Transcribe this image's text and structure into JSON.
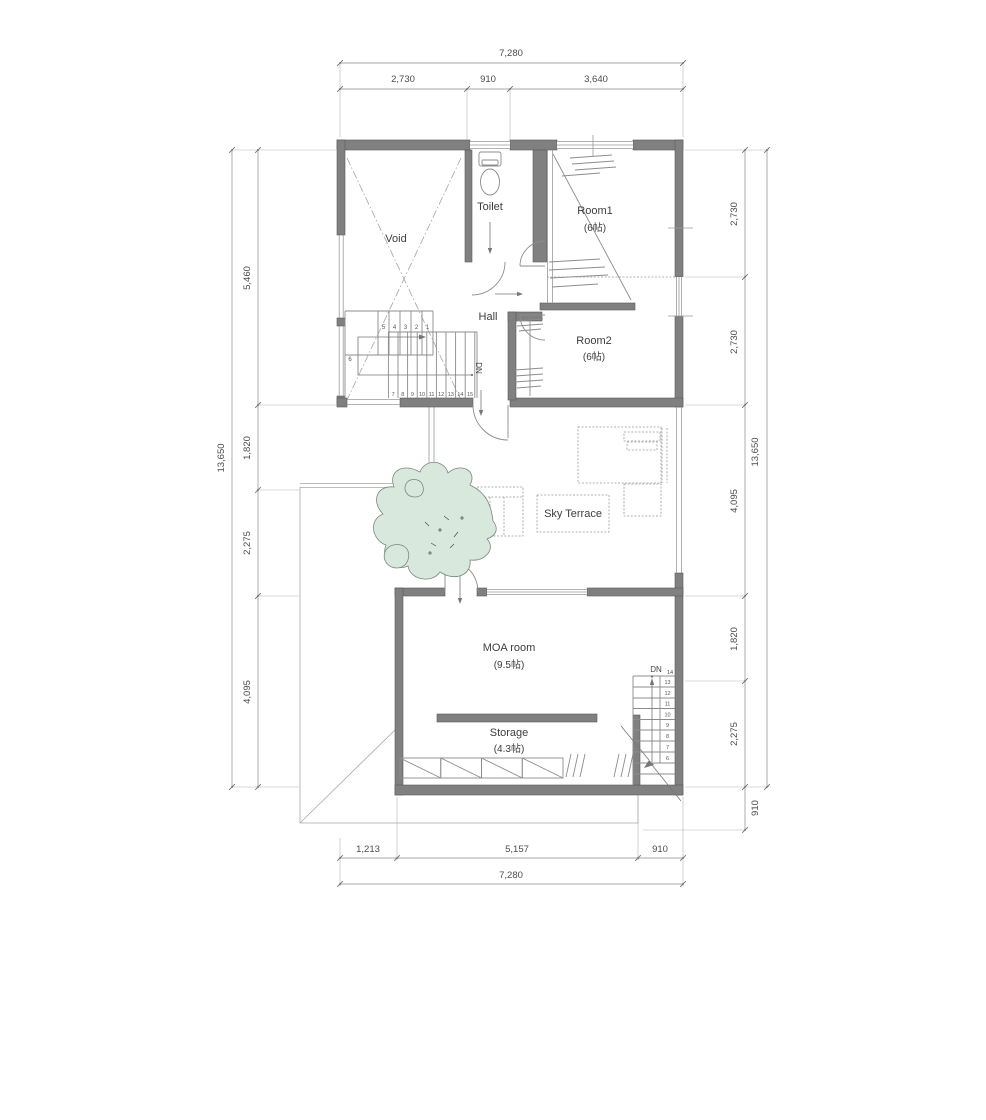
{
  "plan": {
    "rooms": {
      "void": {
        "label": "Void"
      },
      "toilet": {
        "label": "Toilet"
      },
      "hall": {
        "label": "Hall"
      },
      "room1": {
        "label": "Room1",
        "size": "(6帖)"
      },
      "room2": {
        "label": "Room2",
        "size": "(6帖)"
      },
      "sky_terrace": {
        "label": "Sky Terrace"
      },
      "moa_room": {
        "label": "MOA room",
        "size": "(9.5帖)"
      },
      "storage": {
        "label": "Storage",
        "size": "(4.3帖)"
      }
    },
    "stairs": {
      "upper": {
        "direction_label": "DN",
        "upper_treads": [
          "5",
          "4",
          "3",
          "2",
          "1"
        ],
        "winder_tread": "6",
        "lower_treads": [
          "7",
          "8",
          "9",
          "10",
          "11",
          "12",
          "13",
          "14",
          "15"
        ]
      },
      "lower": {
        "direction_label": "DN",
        "top_step": "14",
        "treads": [
          "13",
          "12",
          "11",
          "10",
          "9",
          "8",
          "7",
          "6"
        ]
      }
    },
    "dimensions": {
      "top": {
        "total": "7,280",
        "segments": [
          "2,730",
          "910",
          "3,640"
        ]
      },
      "bottom": {
        "total": "7,280",
        "segments": [
          "1,213",
          "5,157",
          "910"
        ]
      },
      "left": {
        "total": "13,650",
        "segments": [
          "5,460",
          "1,820",
          "2,275",
          "4,095"
        ]
      },
      "right": {
        "total": "13,650",
        "segments": [
          "2,730",
          "2,730",
          "4,095",
          "1,820",
          "2,275",
          "910"
        ]
      }
    },
    "colors": {
      "wall": "#808080",
      "thin_line": "#8c8c8c",
      "tree_fill": "#d9e8dd",
      "tree_stroke": "#77897b",
      "text": "#3d3d3d"
    }
  }
}
